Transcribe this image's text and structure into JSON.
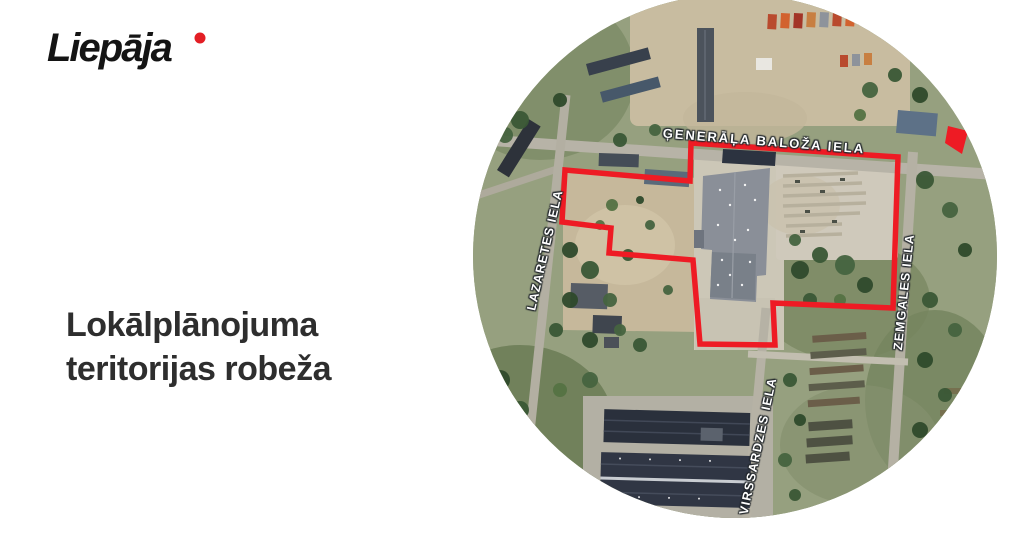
{
  "logo": {
    "text": "Liepāja"
  },
  "headline": {
    "line1": "Lokālplānojuma",
    "line2": "teritorijas robeža"
  },
  "map": {
    "streets": {
      "top": "ĢENERĀĻA BALOŽA IELA",
      "left": "LAZARETES IELA",
      "right": "ZEMGALES IELA",
      "bottom": "VIRSSARDZES IELA"
    },
    "boundary_color": "#ee1b24"
  },
  "colors": {
    "accent_red": "#e31e24",
    "headline_text": "#2e2e2e",
    "logo_text": "#141414"
  }
}
